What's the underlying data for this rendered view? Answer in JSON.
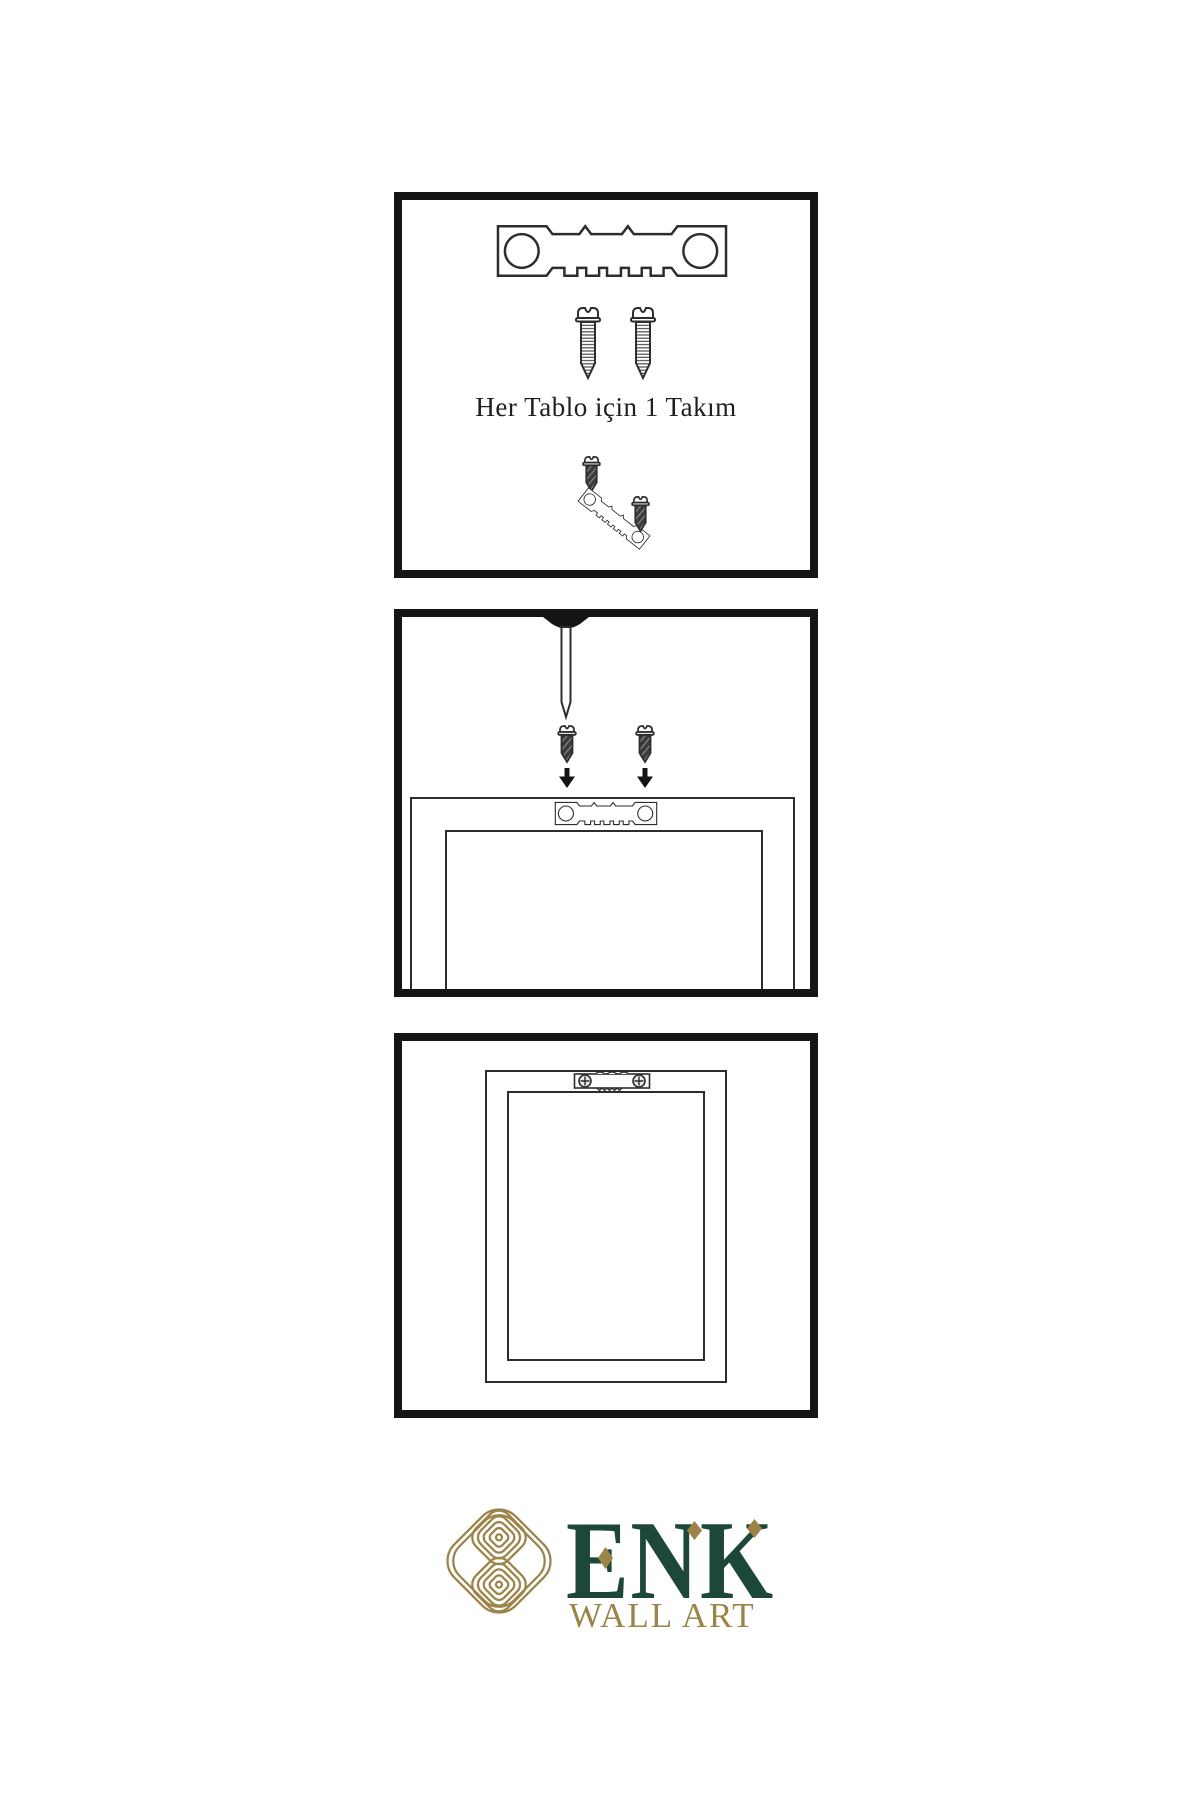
{
  "colors": {
    "ink": "#2d2d2d",
    "panel_border": "#141414",
    "brand_green": "#1d4839",
    "brand_gold": "#9c8448",
    "screw_dark": "#3b3b3b"
  },
  "step_kit": {
    "caption": "Her Tablo için 1 Takım"
  },
  "logo": {
    "brand": "ENK",
    "tagline": "WALL ART"
  },
  "icons": {
    "sawtooth_hanger": "sawtooth-hanger-icon",
    "screw": "screw-icon",
    "nail": "nail-icon",
    "arrow_down": "arrow-down-icon",
    "frame_back": "picture-frame-back",
    "knot": "knot-logo-icon"
  }
}
